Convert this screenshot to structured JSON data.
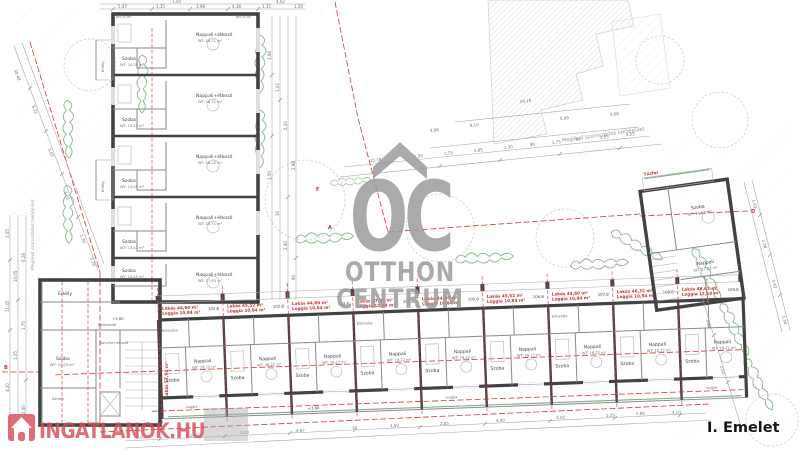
{
  "floor_label": "I. Emelet",
  "watermark_oc": {
    "monogram": "OC",
    "line1": "OTTHON",
    "line2": "CENTRUM",
    "color": "#9c9c9c"
  },
  "watermark_portal": {
    "text": "INGATLANOK.HU",
    "color": "#d84b57"
  },
  "labels": {
    "neighbor_top": "Meglévő szomszédos lakóépület",
    "neighbor_left": "Meglévő szomszédos lakóépület",
    "firewall": "Tűzfal",
    "level_wing": "+3,60",
    "level_corner": "+3,60",
    "sill": "pm 0,90"
  },
  "section_markers": {
    "f": "F",
    "a": "A",
    "b": "B",
    "d": "D"
  },
  "corner": {
    "erkely": "Erkély",
    "szoba": "Szoba",
    "szoba_area": "WT: 15,03 m²",
    "konyha": "Konyha+étkező",
    "kamra": "Kamra",
    "kozlekedo": "Közlekedő",
    "red_side": "Lakás 57,94 m²"
  },
  "right_block": {
    "szoba": "Szoba",
    "szoba_area": "WT: 21,63 m²",
    "nappali": "Nappali",
    "nappali_area": "WT: 17,82 m²"
  },
  "left_wing": {
    "erkely": "Erkély",
    "units": [
      {
        "nappali": "Nappali+étkező",
        "nappali_area": "WT: 18,71 m²",
        "szoba": "Szoba",
        "szoba_area": "WT: 14,05 m²"
      },
      {
        "nappali": "Nappali+étkező",
        "nappali_area": "WT: 18,71 m²",
        "szoba": "Szoba",
        "szoba_area": "WT: 13,42 m²"
      },
      {
        "nappali": "Nappali+étkező",
        "nappali_area": "WT: 18,22 m²",
        "szoba": "Szoba",
        "szoba_area": "WT: 14,05 m²"
      },
      {
        "nappali": "Nappali+étkező",
        "nappali_area": "WT: 18,71 m²",
        "szoba": "Szoba",
        "szoba_area": "WT: 13,42 m²"
      },
      {
        "nappali": "Nappali+étkező",
        "nappali_area": "WT: 17,63 m²",
        "szoba": "Szoba",
        "szoba_area": "WT: 14,05 m²"
      }
    ]
  },
  "bottom_wing": {
    "units": [
      {
        "lakas": "Lakás 44,60 m²",
        "loggia": "Loggia 10,84 m²",
        "code": "101.B",
        "szoba": "Szoba",
        "szoba_area": "WT: 14,04 m²",
        "nappali": "Nappali",
        "nappali_area": "WT: 18,22 m²",
        "loggia_room": "Loggia",
        "eloszoba": "Előszoba"
      },
      {
        "lakas": "Lakás 45,52 m²",
        "loggia": "Loggia 10,84 m²",
        "code": "102.B",
        "szoba": "Szoba",
        "szoba_area": "WT: 14,04 m²",
        "nappali": "Nappali",
        "nappali_area": "WT: 18,22 m²",
        "loggia_room": "Loggia",
        "eloszoba": "Előszoba"
      },
      {
        "lakas": "Lakás 44,60 m²",
        "loggia": "Loggia 10,84 m²",
        "code": "103.B",
        "szoba": "Szoba",
        "szoba_area": "WT: 14,04 m²",
        "nappali": "Nappali",
        "nappali_area": "WT: 18,22 m²",
        "loggia_room": "Loggia",
        "eloszoba": "Előszoba"
      },
      {
        "lakas": "Lakás 47,04 m²",
        "loggia": "Loggia 12,84 m²",
        "code": "104.B",
        "szoba": "Szoba",
        "szoba_area": "WT: 14,04 m²",
        "nappali": "Nappali",
        "nappali_area": "WT: 18,22 m²",
        "loggia_room": "Loggia",
        "eloszoba": "Előszoba"
      },
      {
        "lakas": "Lakás 44,60 m²",
        "loggia": "Loggia 10,84 m²",
        "code": "105.B",
        "szoba": "Szoba",
        "szoba_area": "WT: 14,04 m²",
        "nappali": "Nappali",
        "nappali_area": "WT: 18,22 m²",
        "loggia_room": "Loggia",
        "eloszoba": "Előszoba"
      },
      {
        "lakas": "Lakás 45,52 m²",
        "loggia": "Loggia 10,84 m²",
        "code": "106.B",
        "szoba": "Szoba",
        "szoba_area": "WT: 14,04 m²",
        "nappali": "Nappali",
        "nappali_area": "WT: 18,22 m²",
        "loggia_room": "Loggia",
        "eloszoba": "Előszoba"
      },
      {
        "lakas": "Lakás 44,60 m²",
        "loggia": "Loggia 10,84 m²",
        "code": "107.B",
        "szoba": "Szoba",
        "szoba_area": "WT: 14,04 m²",
        "nappali": "Nappali",
        "nappali_area": "WT: 18,22 m²",
        "loggia_room": "Loggia",
        "eloszoba": "Előszoba"
      },
      {
        "lakas": "Lakás 46,32 m²",
        "loggia": "Loggia 10,84 m²",
        "code": "108.B",
        "szoba": "Szoba",
        "szoba_area": "WT: 14,04 m²",
        "nappali": "Nappali",
        "nappali_area": "WT: 18,22 m²",
        "loggia_room": "Loggia",
        "eloszoba": "Előszoba"
      },
      {
        "lakas": "Lakás 48,62 m²",
        "loggia": "Loggia 12,10 m²",
        "code": "109.B",
        "szoba": "Szoba",
        "szoba_area": "WT: 14,04 m²",
        "nappali": "Nappali",
        "nappali_area": "WT: 18,22 m²",
        "loggia_room": "Loggia",
        "eloszoba": "Előszoba"
      }
    ]
  },
  "dims": {
    "top": [
      "5,47",
      "1,35",
      "1,50",
      "3,98",
      "4,38",
      "1,35",
      "4,02",
      "1,50"
    ],
    "topleft": [
      "30,48",
      "6,22",
      "5,87",
      "3,02",
      "1,30",
      "5,10",
      "1,76",
      "7,36"
    ],
    "courtyard_upper": [
      "24,18",
      "8,10",
      "5,99",
      "4,68",
      "3,98"
    ],
    "courtyard_mid": [
      "15,78",
      "1,50",
      "1,75",
      "2,85",
      "1,30",
      "90",
      "1,75",
      "85",
      "2,05",
      "4,53"
    ],
    "bottom": [
      "4,10",
      "3,10",
      "1,10",
      "4,67",
      "10",
      "1,50",
      "2,85",
      "4,00",
      "3,10",
      "1,35",
      "2,85",
      "4,10"
    ],
    "left": [
      "11,45",
      "10,05",
      "6,28",
      "4,10",
      "1,35",
      "2,40",
      "3,05",
      "1,75"
    ],
    "right": [
      "5,03",
      "2,38",
      "3,43",
      "1,30",
      "5,20",
      "2,02"
    ],
    "wing_right": [
      "3,98",
      "1,02",
      "5,20",
      "2,98",
      "1,50",
      "30",
      "2,40",
      "90"
    ]
  }
}
